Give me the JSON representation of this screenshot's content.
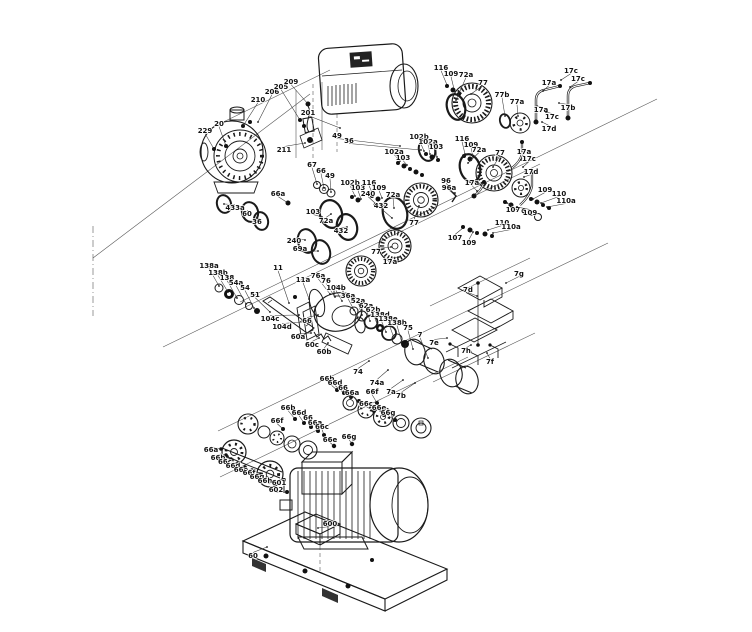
{
  "diagram": {
    "kind": "exploded-parts-diagram",
    "subject": "multistage centrifugal pump with drive motor and base plate",
    "canvas": {
      "width": 752,
      "height": 632
    },
    "colors": {
      "line": "#1a1a1a",
      "background": "#ffffff",
      "label": "#111111"
    }
  },
  "callout_format": [
    "label",
    "x",
    "y",
    "target_x",
    "target_y"
  ],
  "callouts": [
    [
      "229",
      205,
      131,
      214,
      149
    ],
    [
      "20",
      219,
      124,
      226,
      146
    ],
    [
      "210",
      258,
      100,
      243,
      126
    ],
    [
      "206",
      272,
      92,
      258,
      122
    ],
    [
      "205",
      281,
      87,
      300,
      120
    ],
    [
      "209",
      291,
      82,
      308,
      104
    ],
    [
      "201",
      308,
      113,
      340,
      128
    ],
    [
      "211",
      284,
      150,
      305,
      143
    ],
    [
      "433a",
      235,
      208,
      224,
      204
    ],
    [
      "60",
      247,
      214,
      250,
      212
    ],
    [
      "36",
      257,
      222,
      259,
      219
    ],
    [
      "66a",
      278,
      194,
      288,
      203
    ],
    [
      "49",
      337,
      136,
      400,
      146
    ],
    [
      "36",
      349,
      141,
      421,
      150
    ],
    [
      "67",
      312,
      165,
      317,
      184
    ],
    [
      "66",
      321,
      171,
      324,
      188
    ],
    [
      "49",
      330,
      176,
      331,
      192
    ],
    [
      "102b",
      350,
      183,
      355,
      196
    ],
    [
      "103",
      358,
      188,
      361,
      199
    ],
    [
      "116",
      369,
      183,
      373,
      195
    ],
    [
      "109",
      379,
      188,
      382,
      198
    ],
    [
      "240",
      368,
      194,
      376,
      204
    ],
    [
      "72a",
      393,
      195,
      394,
      208
    ],
    [
      "432",
      381,
      206,
      392,
      218
    ],
    [
      "103",
      313,
      212,
      322,
      217
    ],
    [
      "72a",
      326,
      221,
      331,
      214
    ],
    [
      "432",
      341,
      231,
      347,
      227
    ],
    [
      "77",
      414,
      223,
      419,
      206
    ],
    [
      "77",
      376,
      252,
      391,
      247
    ],
    [
      "17a",
      390,
      262,
      399,
      257
    ],
    [
      "240",
      294,
      241,
      305,
      240
    ],
    [
      "69a",
      300,
      249,
      318,
      251
    ],
    [
      "102b",
      419,
      137,
      424,
      151
    ],
    [
      "102a",
      428,
      142,
      430,
      154
    ],
    [
      "103",
      436,
      147,
      437,
      157
    ],
    [
      "102a",
      394,
      152,
      400,
      161
    ],
    [
      "103",
      403,
      158,
      407,
      165
    ],
    [
      "116",
      462,
      139,
      465,
      154
    ],
    [
      "109",
      471,
      145,
      473,
      157
    ],
    [
      "72a",
      479,
      150,
      468,
      163
    ],
    [
      "77",
      500,
      153,
      493,
      167
    ],
    [
      "17a",
      524,
      152,
      521,
      160
    ],
    [
      "17c",
      529,
      159,
      523,
      167
    ],
    [
      "17d",
      531,
      172,
      524,
      177
    ],
    [
      "17a",
      472,
      183,
      477,
      191
    ],
    [
      "96",
      446,
      181,
      452,
      188
    ],
    [
      "96a",
      449,
      188,
      455,
      193
    ],
    [
      "109",
      545,
      190,
      533,
      199
    ],
    [
      "110",
      559,
      194,
      541,
      203
    ],
    [
      "110a",
      566,
      201,
      547,
      207
    ],
    [
      "107",
      513,
      210,
      507,
      203
    ],
    [
      "109",
      530,
      213,
      517,
      207
    ],
    [
      "107",
      455,
      238,
      463,
      228
    ],
    [
      "109",
      469,
      243,
      473,
      232
    ],
    [
      "110",
      502,
      223,
      488,
      230
    ],
    [
      "110a",
      511,
      227,
      493,
      233
    ],
    [
      "116",
      441,
      68,
      447,
      85
    ],
    [
      "109",
      451,
      74,
      454,
      89
    ],
    [
      "72a",
      466,
      75,
      456,
      100
    ],
    [
      "77",
      483,
      83,
      471,
      94
    ],
    [
      "77b",
      502,
      95,
      505,
      116
    ],
    [
      "77a",
      517,
      102,
      518,
      116
    ],
    [
      "17c",
      571,
      71,
      561,
      80
    ],
    [
      "17a",
      549,
      83,
      543,
      91
    ],
    [
      "17c",
      578,
      79,
      570,
      87
    ],
    [
      "17b",
      568,
      108,
      559,
      103
    ],
    [
      "17a",
      541,
      110,
      537,
      106
    ],
    [
      "17c",
      552,
      117,
      546,
      112
    ],
    [
      "17d",
      549,
      129,
      542,
      122
    ],
    [
      "138a",
      209,
      266,
      219,
      286
    ],
    [
      "138b",
      218,
      273,
      228,
      292
    ],
    [
      "138",
      227,
      278,
      237,
      298
    ],
    [
      "54a",
      236,
      283,
      246,
      304
    ],
    [
      "54",
      245,
      288,
      254,
      308
    ],
    [
      "51",
      255,
      295,
      270,
      312
    ],
    [
      "11",
      278,
      268,
      289,
      303
    ],
    [
      "11a",
      303,
      280,
      309,
      299
    ],
    [
      "76a",
      318,
      276,
      330,
      294
    ],
    [
      "76",
      326,
      281,
      335,
      297
    ],
    [
      "104b",
      336,
      288,
      342,
      301
    ],
    [
      "36a",
      348,
      296,
      354,
      310
    ],
    [
      "52a",
      358,
      301,
      362,
      315
    ],
    [
      "62a",
      366,
      306,
      370,
      321
    ],
    [
      "62b",
      373,
      310,
      378,
      327
    ],
    [
      "138d",
      380,
      315,
      386,
      332
    ],
    [
      "138e",
      388,
      319,
      394,
      338
    ],
    [
      "138b",
      397,
      323,
      402,
      343
    ],
    [
      "75",
      408,
      328,
      413,
      349
    ],
    [
      "7",
      420,
      335,
      428,
      358
    ],
    [
      "104c",
      270,
      319,
      299,
      315
    ],
    [
      "104d",
      282,
      327,
      303,
      322
    ],
    [
      "66",
      307,
      321,
      318,
      315
    ],
    [
      "60a",
      298,
      337,
      311,
      333
    ],
    [
      "60c",
      312,
      345,
      319,
      338
    ],
    [
      "60b",
      324,
      352,
      328,
      343
    ],
    [
      "74",
      358,
      372,
      369,
      361
    ],
    [
      "74a",
      377,
      383,
      388,
      370
    ],
    [
      "7a",
      391,
      392,
      403,
      380
    ],
    [
      "7b",
      401,
      396,
      415,
      383
    ],
    [
      "7g",
      519,
      274,
      506,
      283
    ],
    [
      "7d",
      468,
      290,
      477,
      296
    ],
    [
      "7e",
      434,
      343,
      447,
      338
    ],
    [
      "7h",
      466,
      351,
      471,
      345
    ],
    [
      "7f",
      490,
      362,
      487,
      353
    ],
    [
      "66b",
      327,
      379,
      337,
      390
    ],
    [
      "66d",
      335,
      383,
      344,
      393
    ],
    [
      "66",
      343,
      388,
      351,
      398
    ],
    [
      "66a",
      352,
      393,
      359,
      402
    ],
    [
      "66f",
      372,
      392,
      377,
      403
    ],
    [
      "66c",
      366,
      404,
      374,
      411
    ],
    [
      "66e",
      379,
      408,
      384,
      415
    ],
    [
      "66g",
      388,
      413,
      395,
      420
    ],
    [
      "66b",
      288,
      408,
      295,
      419
    ],
    [
      "66d",
      299,
      413,
      304,
      423
    ],
    [
      "66",
      308,
      418,
      311,
      427
    ],
    [
      "66a",
      315,
      423,
      318,
      431
    ],
    [
      "66c",
      322,
      427,
      324,
      435
    ],
    [
      "66f",
      277,
      421,
      283,
      429
    ],
    [
      "66e",
      330,
      440,
      334,
      446
    ],
    [
      "66g",
      349,
      437,
      352,
      444
    ],
    [
      "66a",
      211,
      450,
      221,
      449
    ],
    [
      "66b",
      218,
      458,
      226,
      455
    ],
    [
      "66c",
      225,
      462,
      231,
      459
    ],
    [
      "66d",
      233,
      466,
      238,
      463
    ],
    [
      "66e",
      241,
      470,
      245,
      467
    ],
    [
      "66f",
      249,
      473,
      252,
      470
    ],
    [
      "66g",
      257,
      477,
      259,
      474
    ],
    [
      "66h",
      265,
      481,
      267,
      478
    ],
    [
      "601",
      279,
      483,
      284,
      480
    ],
    [
      "602",
      276,
      490,
      287,
      492
    ],
    [
      "600",
      330,
      524,
      318,
      528
    ],
    [
      "60",
      253,
      556,
      267,
      547
    ]
  ]
}
